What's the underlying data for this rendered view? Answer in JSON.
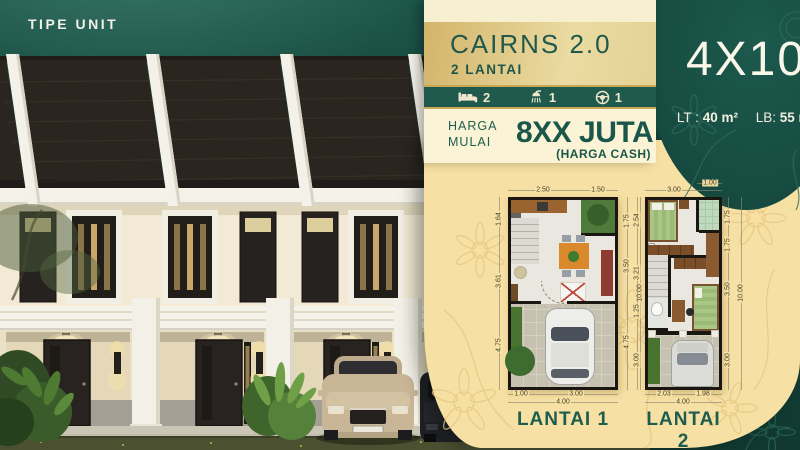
{
  "header": {
    "tipe_unit_label": "TIPE UNIT"
  },
  "product": {
    "name": "CAIRNS 2.0",
    "floors": "2 LANTAI",
    "specs": [
      {
        "icon": "bed-icon",
        "value": "2"
      },
      {
        "icon": "shower-icon",
        "value": "1"
      },
      {
        "icon": "steering-wheel-icon",
        "value": "1"
      }
    ],
    "price": {
      "label_line1": "HARGA",
      "label_line2": "MULAI",
      "amount": "8XX JUTA",
      "note": "(HARGA CASH)"
    },
    "size": {
      "dimension": "4X10",
      "lt_label": "LT :",
      "lt_value": "40 m²",
      "lb_label": "LB:",
      "lb_value": "55 m²"
    }
  },
  "floor_plans": [
    {
      "label": "LANTAI 1",
      "dims_top": [
        "2.50",
        "1.50"
      ],
      "dims_left": [
        "1.64",
        "3.61",
        "4.75"
      ],
      "dims_right": [
        "1.75",
        "3.50",
        "4.75"
      ],
      "total_height": "10.00",
      "dims_bottom": [
        "1.00",
        "3.00"
      ],
      "total_width": "4.00"
    },
    {
      "label": "LANTAI 2",
      "dims_top": [
        "3.00",
        "1.00"
      ],
      "dims_left": [
        "2.54",
        "3.21",
        "1.25",
        "3.00"
      ],
      "dims_right": [
        "1.75",
        "1.75",
        "3.50",
        "3.00"
      ],
      "total_height": "10.00",
      "dims_bottom": [
        "2.03",
        "1.98"
      ],
      "total_width": "4.00"
    }
  ],
  "colors": {
    "deep_green": "#154A40",
    "panel_green": "#1A5348",
    "bar_green": "#1F5A4C",
    "text_green": "#1D5D4F",
    "gold": "#C9A855",
    "blob_gold": "#F7E0A3",
    "cream": "#F7F0D0"
  }
}
